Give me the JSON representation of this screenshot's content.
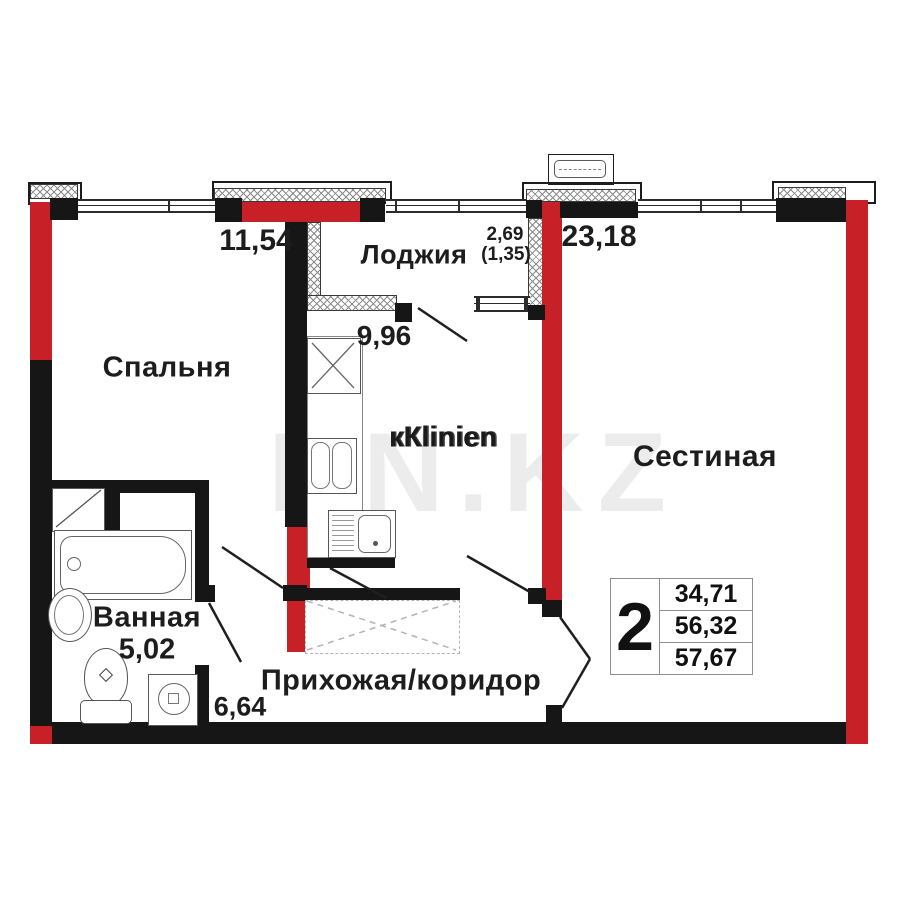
{
  "floorplan": {
    "rooms": {
      "bedroom": {
        "label": "Спальня",
        "area": "11,54"
      },
      "loggia": {
        "label": "Лоджия",
        "area": "2,69",
        "area_coefficient": "(1,35)"
      },
      "kitchen": {
        "area": "9,96",
        "label_garbled": "кКlinien"
      },
      "living_room": {
        "label": "Сестиная",
        "area": "23,18"
      },
      "bathroom": {
        "label": "Ванная",
        "area": "5,02"
      },
      "hallway": {
        "label": "Прихожая/коридор",
        "area": "6,64"
      }
    },
    "info_table": {
      "rooms_count": "2",
      "living_area": "34,71",
      "area_without_loggia": "56,32",
      "total_area": "57,67"
    },
    "watermark": {
      "text": "KN.KZ"
    },
    "colors": {
      "wall_red": "#c72127",
      "wall_black": "#161616"
    }
  }
}
